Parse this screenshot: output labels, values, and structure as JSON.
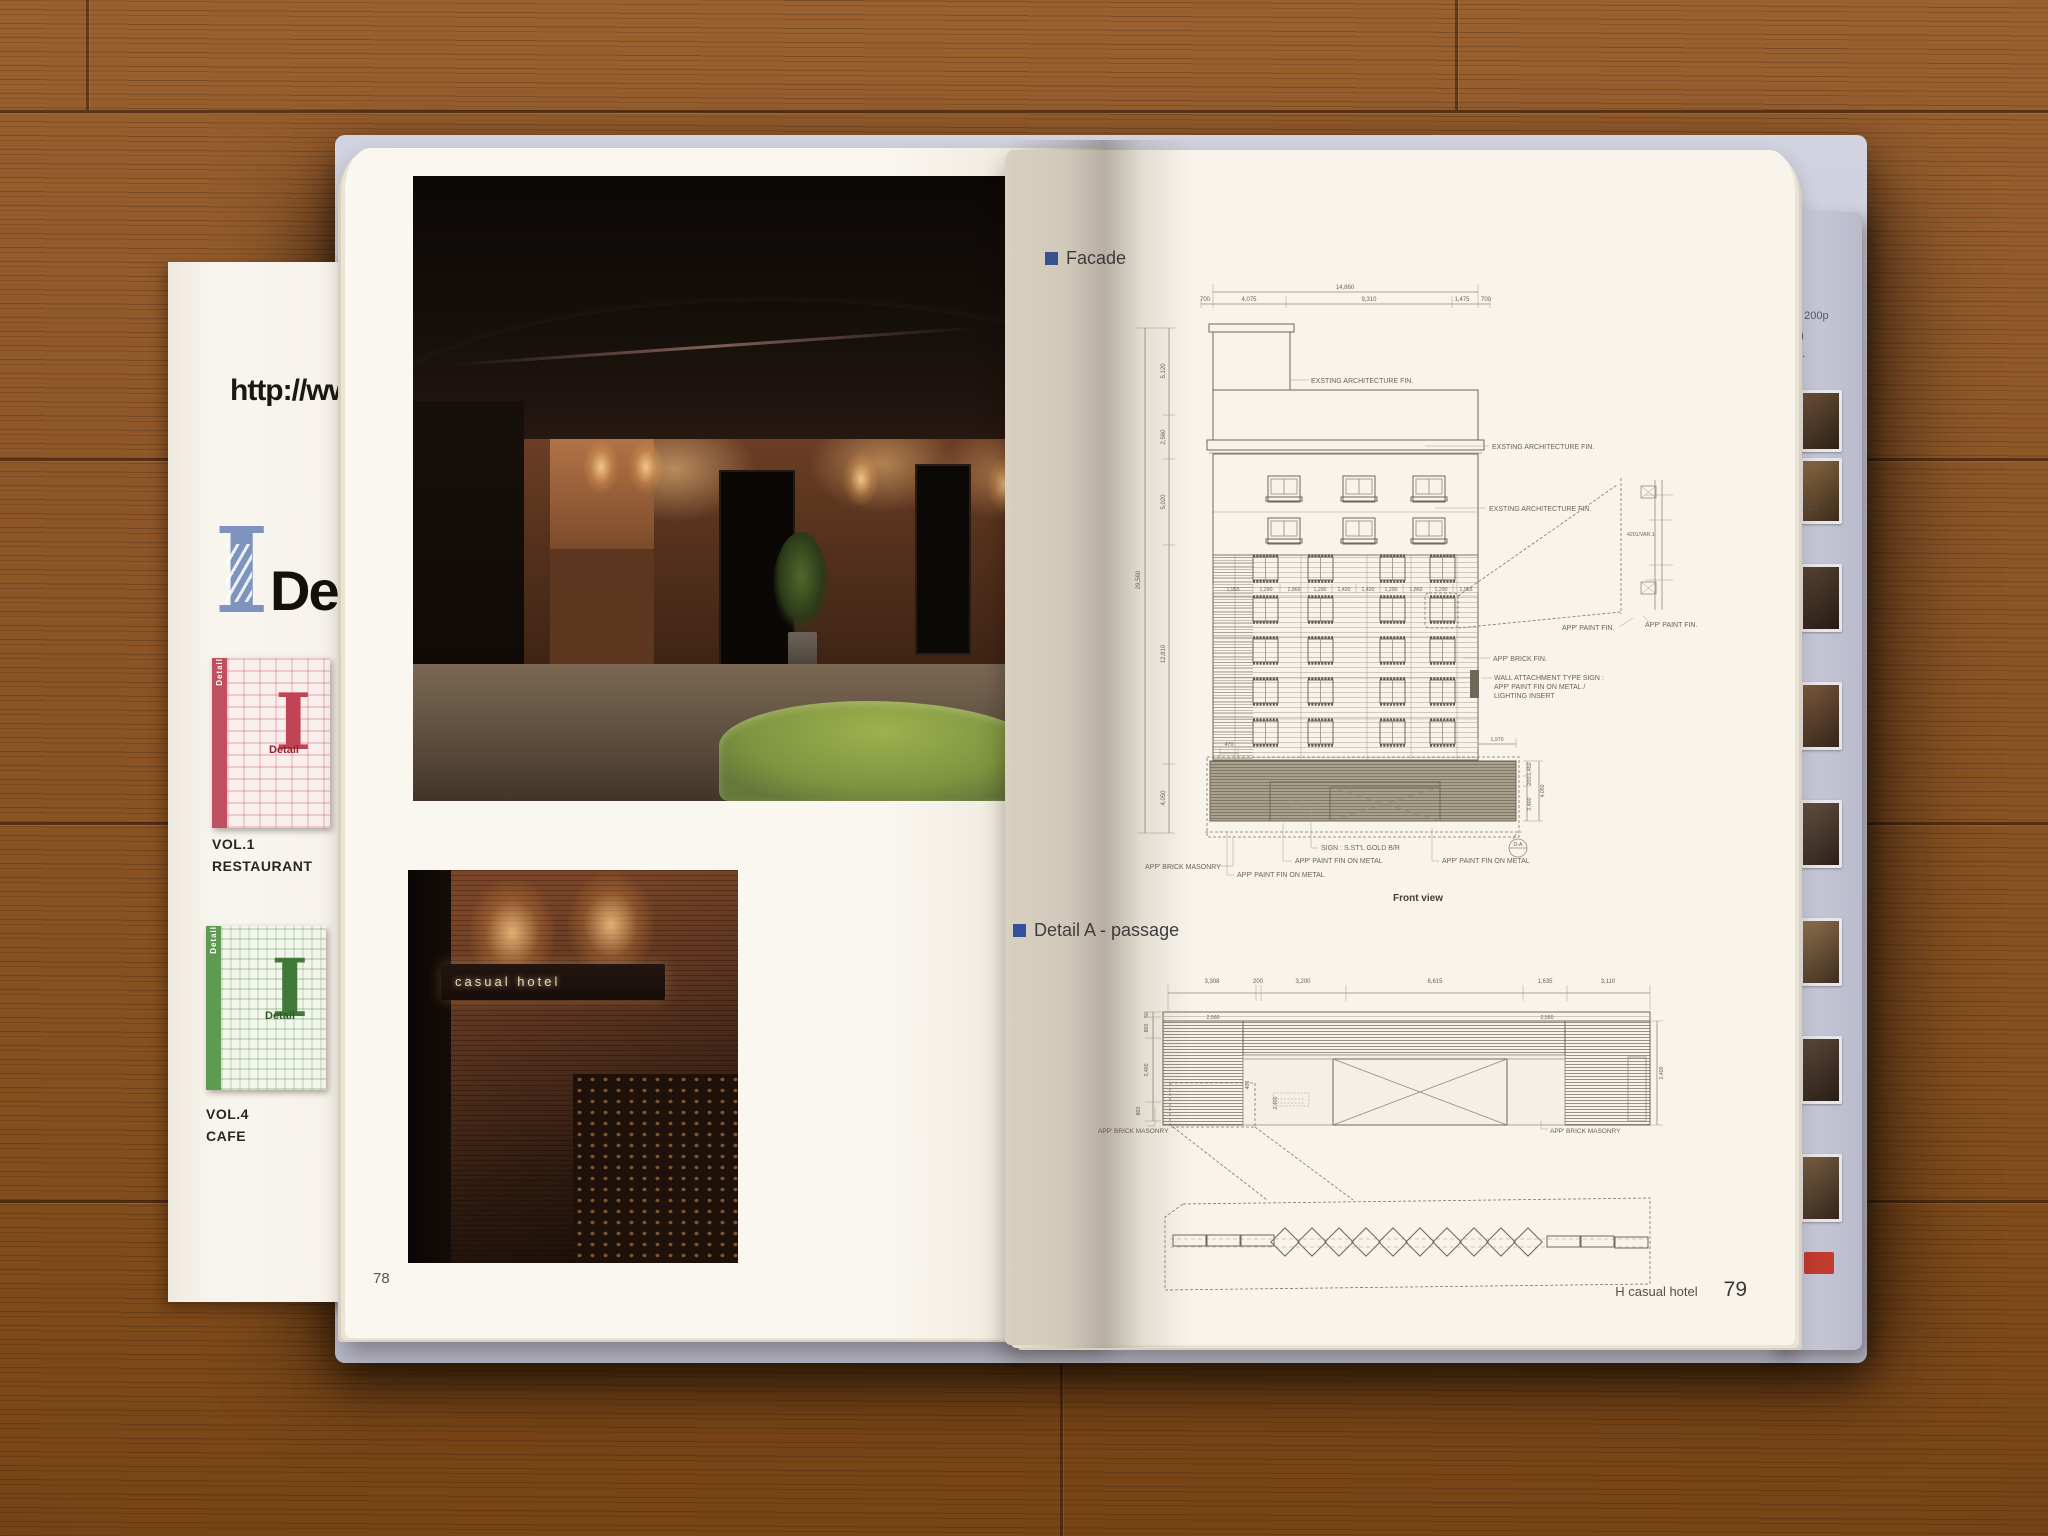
{
  "palette": {
    "accent_blue": "#31519c",
    "logo_blue": "#7e94bf",
    "vol1_red": "#c05060",
    "vol4_green": "#5f9a52",
    "cover_lavender": "#c7c8d8",
    "tab_red": "#c23b30"
  },
  "left_insert": {
    "url_text": "http://ww",
    "logo_i": "I",
    "logo_rest": "De",
    "vol1": {
      "logo_i": "I",
      "label": "Detail",
      "spine": "Detail",
      "vol": "VOL.1",
      "category": "RESTAURANT"
    },
    "vol4": {
      "logo_i": "I",
      "label": "Detail",
      "spine": "Detail",
      "vol": "VOL.4",
      "category": "CAFE"
    }
  },
  "left_page": {
    "page_number": "78",
    "photo2_sign": "casual hotel"
  },
  "right_page": {
    "facade": {
      "title": "Facade",
      "caption": "Front view",
      "dims": {
        "top_total": "14,860",
        "top_segments": [
          "700",
          "4,075",
          "9,310",
          "1,475",
          "700"
        ],
        "left_total": "29,560",
        "left_segments": [
          "5,120",
          "2,560",
          "5,020",
          "12,810",
          "4,050"
        ],
        "window_row": [
          "1,955",
          "1,290",
          "1,860",
          "1,290",
          "1,420",
          "1,420",
          "1,290",
          "1,860",
          "1,290",
          "1,955"
        ],
        "canopy_offset": "470",
        "right_ext": "1,970",
        "right_stack": [
          "1,450",
          "200",
          "4,050",
          "2,400"
        ]
      },
      "labels": {
        "existing1": "EXSTING ARCHITECTURE FIN.",
        "existing2": "EXSTING ARCHITECTURE FIN.",
        "existing3": "EXSTING ARCHITECTURE FIN.",
        "paint_fin": "APP' PAINT FIN.",
        "brick_fin": "APP' BRICK FIN.",
        "wall_sign_1": "WALL ATTACHMENT TYPE SIGN :",
        "wall_sign_2": "APP' PAINT FIN ON METAL /",
        "wall_sign_3": "LIGHTING INSERT",
        "brick_masonry": "APP' BRICK MASONRY",
        "sign": "SIGN : S.ST'L GOLD B/R",
        "paint_metal_1": "APP' PAINT FIN ON METAL",
        "paint_metal_2": "APP' PAINT FIN ON METAL",
        "paint_metal_3": "APP' PAINT FIN ON METAL",
        "inset_code": "4201/VAR.1",
        "inset_paint_fin": "APP' PAINT FIN.",
        "detail_mark": "D-A"
      }
    },
    "detail_a": {
      "title": "Detail A - passage",
      "dims": {
        "top_segments": [
          "3,308",
          "200",
          "3,200",
          "6,615",
          "1,635",
          "3,110"
        ],
        "left_stack": [
          "50",
          "800",
          "2,400",
          "800"
        ],
        "band_left": "2,560",
        "band_right": "2,560",
        "inner_small": "400",
        "inner_height": "2,400",
        "right_height": "2,400"
      },
      "labels": {
        "brick_masonry_left": "APP' BRICK MASONRY",
        "brick_masonry_right": "APP' BRICK MASONRY"
      }
    },
    "footer": {
      "book_title": "H casual hotel",
      "page_number": "79"
    }
  },
  "edge_page": {
    "note1": ": 200p",
    "note2": "0)",
    "note3": "d.",
    "page_ref": "123"
  }
}
